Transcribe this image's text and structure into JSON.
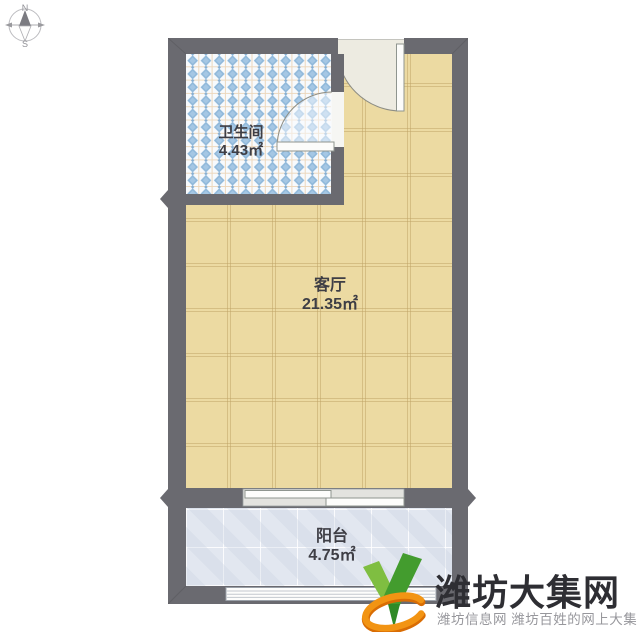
{
  "compass": {
    "north": "N",
    "south": "S"
  },
  "rooms": {
    "bathroom": {
      "label": "卫生间",
      "area": "4.43㎡"
    },
    "living": {
      "label": "客厅",
      "area": "21.35㎡"
    },
    "balcony": {
      "label": "阳台",
      "area": "4.75㎡"
    }
  },
  "watermark": {
    "site_name": "潍坊大集网",
    "tagline": "潍坊信息网 潍坊百姓的网上大集"
  },
  "palette": {
    "wall": "#6a6a70",
    "living_floor": "#ecdaa2",
    "bathroom_floor": "#f7fafd",
    "bathroom_diamond": "#8fb8da",
    "balcony_floor": "#e2e7f0",
    "entry_floor": "#edebe1",
    "door_leaf": "#fcfcfa",
    "label_text": "#3e3e45",
    "logo_green_light": "#7fbe41",
    "logo_green_dark": "#439c2e",
    "logo_orange": "#f29413",
    "watermark_title": "#2e2e33",
    "watermark_tagline": "#97979c"
  }
}
